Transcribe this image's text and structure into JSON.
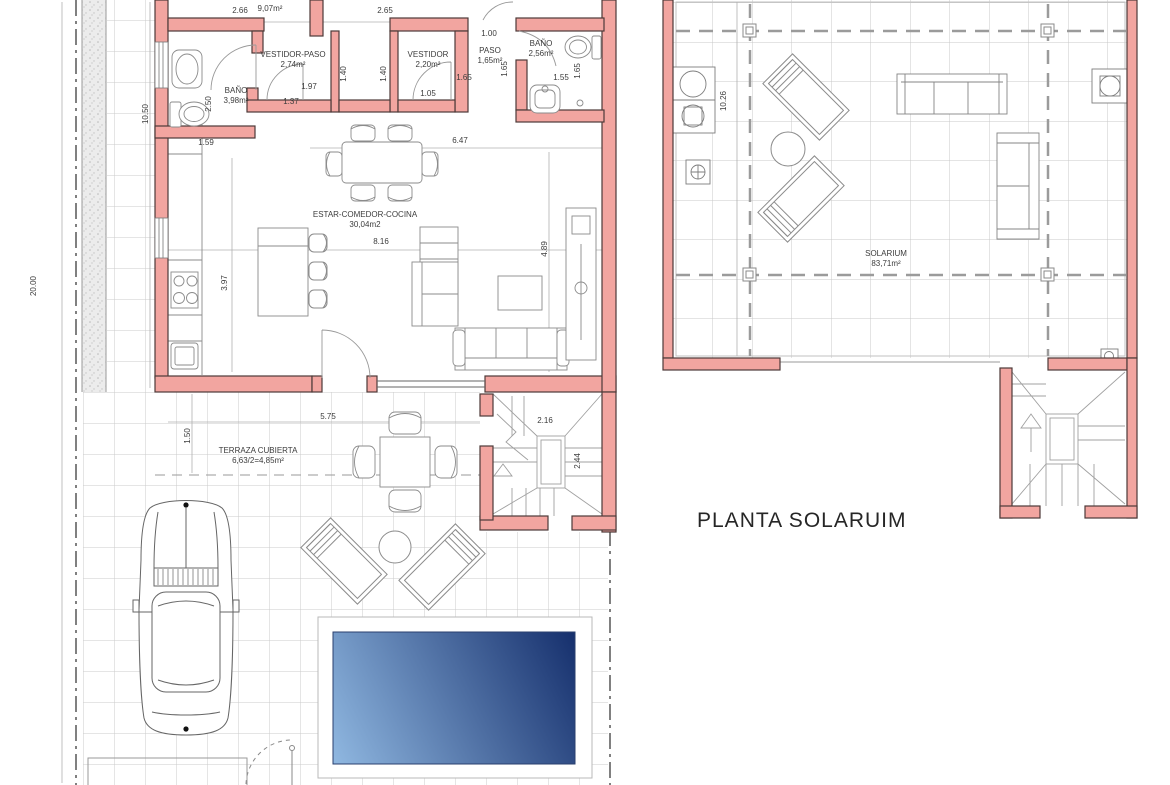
{
  "plan_title": "PLANTA SOLARUIM",
  "ground_floor": {
    "bathroom1": {
      "name": "BAÑO",
      "area": "3,98m²"
    },
    "dressing_hall": {
      "name": "VESTIDOR-PASO",
      "area": "2,74m²"
    },
    "dressing": {
      "name": "VESTIDOR",
      "area": "2,20m²"
    },
    "hall": {
      "name": "PASO",
      "area": "1,65m²"
    },
    "bathroom2": {
      "name": "BAÑO",
      "area": "2,56m²"
    },
    "living": {
      "name": "ESTAR-COMEDOR-COCINA",
      "area": "30,04m2"
    },
    "terrace": {
      "name": "TERRAZA CUBIERTA",
      "area": "6,63/2=4,85m²"
    }
  },
  "solarium": {
    "name": "SOLARIUM",
    "area": "83,71m²"
  },
  "dimensions": {
    "plot_height": "20.00",
    "plot_side": "10.50",
    "room1_w": "2.66",
    "room1_area": "9,07m²",
    "room2_w": "2.65",
    "hall_top_w": "1.00",
    "bath1_h": "2.50",
    "bath1_w": "1.59",
    "dressing_hall_w1": "1.97",
    "dressing_hall_w2": "1.37",
    "closet1_d": "1.40",
    "closet2_d": "1.40",
    "dressing_w": "1.65",
    "dressing_d": "1.05",
    "hall_d": "1.65",
    "bath2_w": "1.55",
    "bath2_d": "1.65",
    "living_w_top": "6.47",
    "living_w": "8.16",
    "living_d": "4.89",
    "kitchen_d": "3.97",
    "terrace_w": "5.75",
    "terrace_d": "1.50",
    "stair_w": "2.16",
    "stair_d": "2.44",
    "solarium_side": "10.26"
  },
  "colors": {
    "wall_fill": "#f2a5a0",
    "wall_stroke": "#4d3a38",
    "pool_light": "#8fb7e0",
    "pool_dark": "#17316e"
  }
}
